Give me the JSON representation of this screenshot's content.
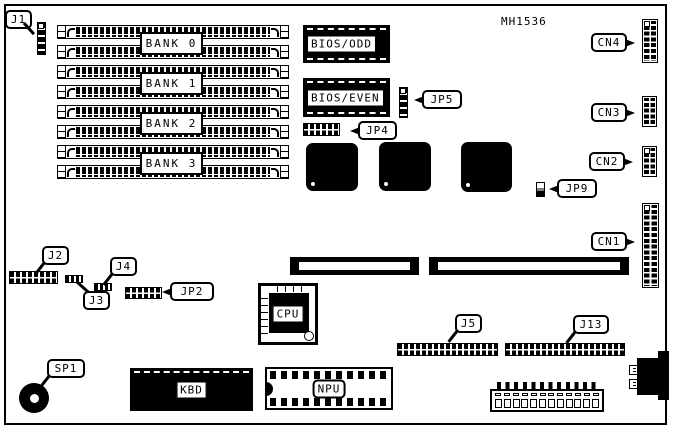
{
  "board": {
    "part_number": "MH1536"
  },
  "memory": {
    "simm_slot_count": 8,
    "bank_labels": [
      "BANK 0",
      "BANK 1",
      "BANK 2",
      "BANK 3"
    ]
  },
  "chips": {
    "bios_odd": "BIOS/ODD",
    "bios_even": "BIOS/EVEN",
    "cpu": "CPU",
    "npu": "NPU",
    "kbd": "KBD"
  },
  "callouts": {
    "j1": "J1",
    "j2": "J2",
    "j3": "J3",
    "j4": "J4",
    "j5": "J5",
    "j13": "J13",
    "jp2": "JP2",
    "jp4": "JP4",
    "jp5": "JP5",
    "jp9": "JP9",
    "cn1": "CN1",
    "cn2": "CN2",
    "cn3": "CN3",
    "cn4": "CN4",
    "sp1": "SP1"
  },
  "connectors": {
    "power_pin_count": 12,
    "cn1_pin_layout": "2x12",
    "cn2_pin_layout": "2x5",
    "cn3_pin_layout": "2x5",
    "cn4_pin_layout": "2x8"
  },
  "colors": {
    "background": "#ffffff",
    "line": "#000000"
  }
}
